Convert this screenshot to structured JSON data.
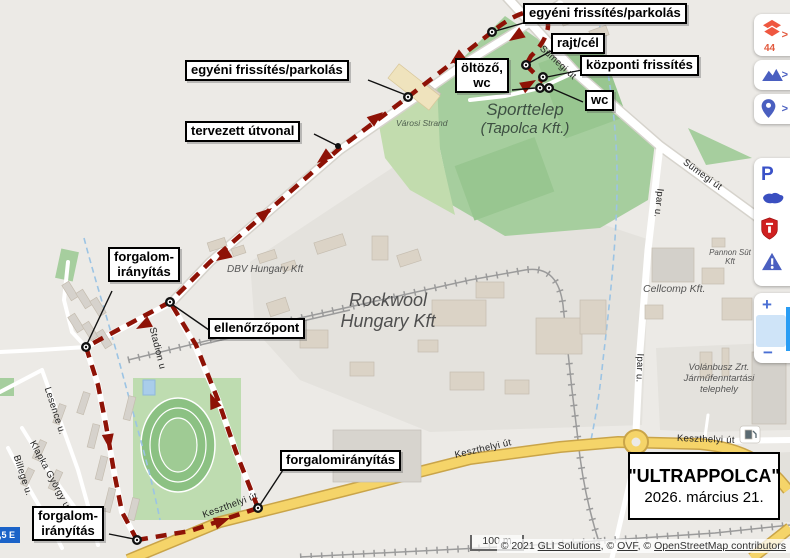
{
  "annotations": {
    "egyeni_top": "egyéni frissítés/parkolás",
    "rajt_cel": "rajt/cél",
    "kozponti": "központi frissítés",
    "oltozo_line1": "öltöző,",
    "oltozo_line2": "wc",
    "wc": "wc",
    "egyeni_left": "egyéni frissítés/parkolás",
    "tervezett": "tervezett útvonal",
    "forgalom_left_line1": "forgalom-",
    "forgalom_left_line2": "irányítás",
    "ellenorzopont": "ellenőrzőpont",
    "forgalom_mid": "forgalomirányítás",
    "forgalom_bottom_line1": "forgalom-",
    "forgalom_bottom_line2": "irányítás"
  },
  "event_box": {
    "title": "\"ULTRAPPOLCA\"",
    "date": "2026. március 21."
  },
  "streets": {
    "sumegi_1": "Sümegi út",
    "sumegi_2": "Sümegi út",
    "ipar_1": "Ipar u.",
    "ipar_2": "Ipar u.",
    "keszthelyi_1": "Keszthelyi út",
    "keszthelyi_2": "Keszthelyi út",
    "keszthelyi_3": "Keszthelyi út",
    "stadion": "Stadion u",
    "lesence": "Lesence u.",
    "klapka": "Klapka György u.",
    "billege": "Billege u."
  },
  "places": {
    "sporttelep_line1": "Sporttelep",
    "sporttelep_line2": "(Tapolca Kft.)",
    "varosi_strand": "Városi Strand",
    "rockwool_line1": "Rockwool",
    "rockwool_line2": "Hungary Kft",
    "dbv": "DBV Hungary Kft",
    "pannon_line1": "Pannon Süt",
    "pannon_line2": "Kft",
    "cellcomp": "Cellcomp Kft.",
    "volanbusz_line1": "Volánbusz Zrt.",
    "volanbusz_line2": "Járműfenntartási",
    "volanbusz_line3": "telephely"
  },
  "controls": {
    "layers_count": "44",
    "chevron": ">",
    "parking": "P",
    "zoom_in": "+",
    "zoom_out": "−"
  },
  "scale_bar": {
    "label": "100 m"
  },
  "attribution": {
    "prefix": "© 2021 ",
    "link1": "GLI Solutions",
    "sep1": ", © ",
    "link2": "OVF",
    "sep2": ", © ",
    "link3": "OpenStreetMap contributors"
  },
  "badge": {
    "text": ",5 E"
  },
  "colors": {
    "route": "#8e1206",
    "accent_orange": "#ef5740",
    "accent_blue": "#4a5fc0",
    "road_yellow": "#f5d469",
    "area_green": "#a6ce9e"
  }
}
